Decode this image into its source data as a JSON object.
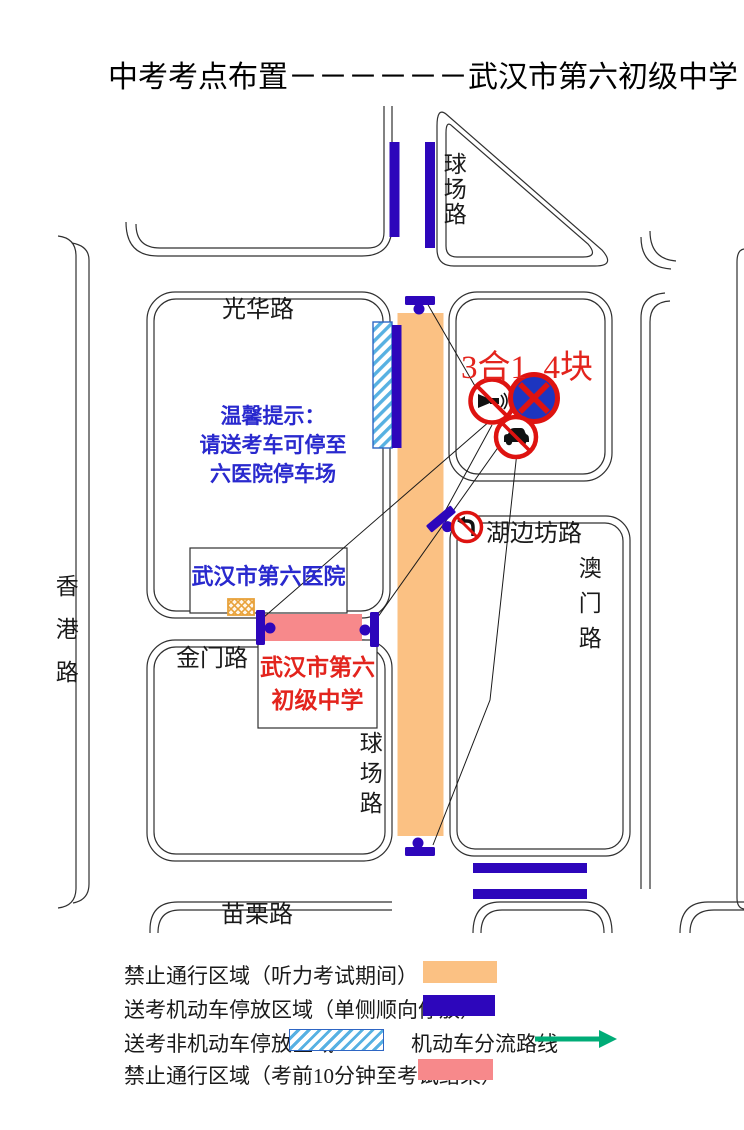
{
  "title": "中考考点布置－－－－－－武汉市第六初级中学",
  "colors": {
    "orange": "#FBC183",
    "navy": "#2D06BB",
    "pink": "#F7898B",
    "hatch_stripe": "#57B1E2",
    "hatch_border": "#2E66C4",
    "red_text": "#E3241D",
    "blue_text": "#2929CE",
    "sign_red": "#DE1310",
    "sign_blue": "#1D35C0",
    "green": "#00AC77",
    "gate": "#E8A23B",
    "road": "#303030"
  },
  "map": {
    "road_labels": {
      "guanghua": "光华路",
      "qiuchang_north": "球场路",
      "qiuchang_south": "球场路",
      "xianggang": "香港路",
      "jinmen": "金门路",
      "miaoli": "苗栗路",
      "hubianfang": "湖边坊路",
      "aomen": "澳门路"
    },
    "notice": {
      "line1": "温馨提示：",
      "line2": "请送考车可停至",
      "line3": "六医院停车场"
    },
    "hospital_label": "武汉市第六医院",
    "school": {
      "line1": "武汉市第六",
      "line2": "初级中学"
    },
    "signs_note": "3合1  4块"
  },
  "legend": {
    "items": [
      {
        "label": "禁止通行区域（听力考试期间）"
      },
      {
        "label": "送考机动车停放区域（单侧顺向停放）"
      },
      {
        "label": "送考非机动车停放区域"
      },
      {
        "label": "禁止通行区域（考前10分钟至考试结束）"
      }
    ],
    "flow_label": "机动车分流路线"
  }
}
